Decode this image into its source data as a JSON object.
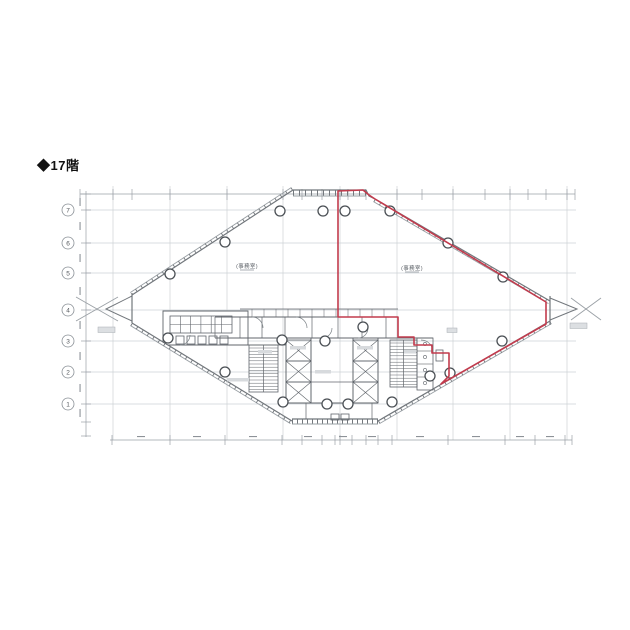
{
  "page": {
    "background": "#ffffff"
  },
  "title": {
    "label": "◆17階"
  },
  "plan": {
    "axis_rows": [
      "7",
      "6",
      "5",
      "4",
      "3",
      "2",
      "1"
    ],
    "labels": {
      "office_left": "(事務室)",
      "office_right": "(事務室)"
    },
    "colors": {
      "highlight_red": "#c23b4d",
      "drawing_line": "#72777c",
      "grid_line": "#cdd2d6",
      "dimension_line": "#9aa0a6"
    }
  }
}
